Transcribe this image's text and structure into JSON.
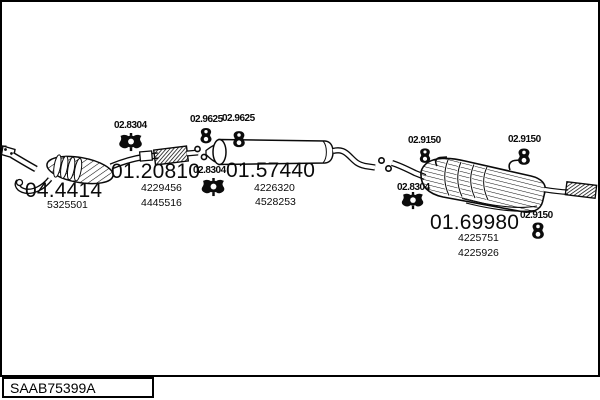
{
  "footer": {
    "diagram_code": "SAAB75399A"
  },
  "parts": {
    "catalyst": {
      "code": "04.4414",
      "numbers": [
        "5325501"
      ]
    },
    "front_pipe": {
      "code": "01.20810",
      "numbers": [
        "4229456",
        "4445516"
      ]
    },
    "middle_muffler": {
      "code": "01.57440",
      "numbers": [
        "4226320",
        "4528253"
      ]
    },
    "rear_muffler": {
      "code": "01.69980",
      "numbers": [
        "4225751",
        "4225926"
      ]
    }
  },
  "fittings": {
    "clamp_front": {
      "code": "02.8304"
    },
    "clamp_middle": {
      "code": "02.8304"
    },
    "clamp_rear": {
      "code": "02.8304"
    },
    "hanger_front_1": {
      "code": "02.9625"
    },
    "hanger_front_2": {
      "code": "02.9625"
    },
    "hanger_rear_1": {
      "code": "02.9150"
    },
    "hanger_rear_2": {
      "code": "02.9150"
    },
    "hanger_rear_3": {
      "code": "02.9150"
    }
  },
  "colors": {
    "line": "#0a0a0a",
    "background": "#ffffff"
  }
}
